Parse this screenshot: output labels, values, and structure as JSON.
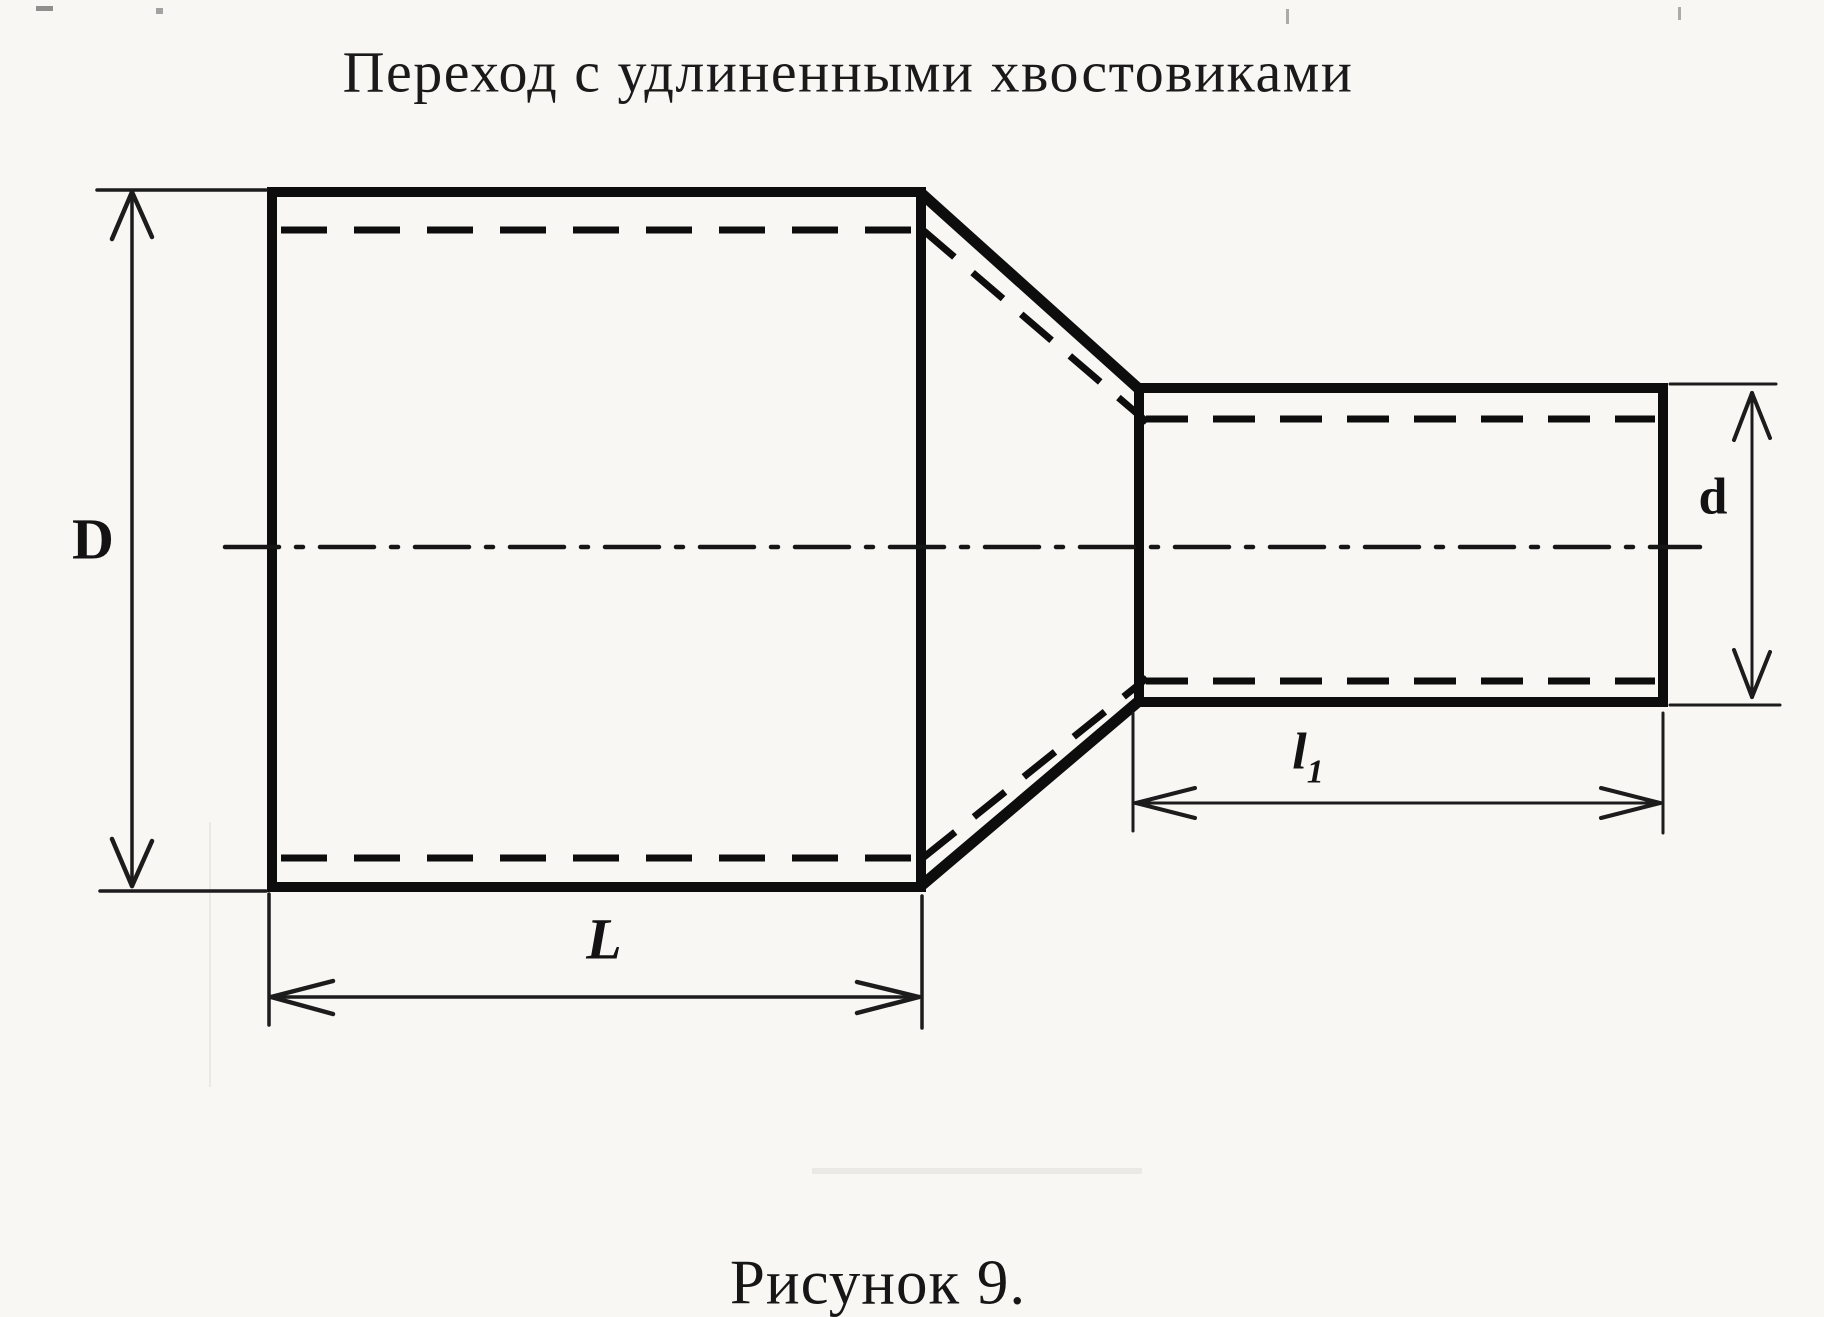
{
  "title": "Переход с удлиненными хвостовиками",
  "caption": "Рисунок 9.",
  "dimension_labels": {
    "big_diameter": "D",
    "small_diameter": "d",
    "big_length": "L",
    "small_length_base": "l",
    "small_length_sub": "1"
  },
  "colors": {
    "paper": "#f8f7f4",
    "ink": "#0d0d0d"
  }
}
